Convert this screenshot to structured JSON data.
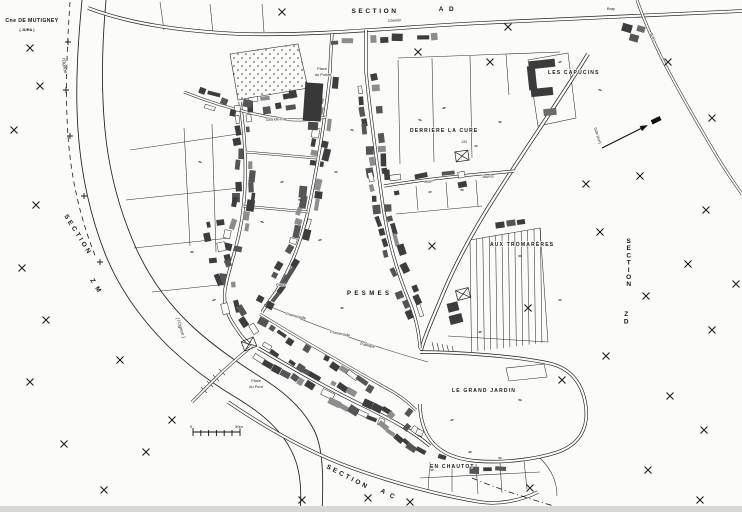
{
  "labels": {
    "commune_note": {
      "line1": "Cne DE MUTIGNEY",
      "line2": "( JURA )"
    },
    "sections": {
      "ad": {
        "word": "SECTION",
        "code": "AD"
      },
      "zm": {
        "word": "SECTION",
        "code": "ZM"
      },
      "zd": {
        "word": "SECTION",
        "code": "ZD"
      },
      "ac": {
        "word": "SECTION",
        "code": "AC"
      }
    },
    "lieux": {
      "capucins": "LES CAPUCINS",
      "cure": "DERRIERE LA CURE",
      "cure_parcel": "133",
      "tromareres": "AUX TROMARÈRES",
      "pesmes": "PESMES",
      "grand_jardin": "LE GRAND JARDIN",
      "chautot": "EN CHAUTOT"
    },
    "streets": {
      "chemin": "Chemin",
      "bray": "Bray",
      "gde_rue": "Gde (rue)",
      "jean": "Jean",
      "jaures": "Jaurès",
      "grande_rue": "Grande Rue",
      "place": "Place",
      "du_portail": "du Portail",
      "promenade": "Promenade",
      "publique": "Publique",
      "du_pont": "du Pont"
    },
    "river": {
      "small": "l'Ognon",
      "main": "( l'Ognon )"
    }
  },
  "scale_bar": {
    "left": "0",
    "right": "50m"
  },
  "icons": {
    "north_arrow": "north-arrow",
    "survey_cross": "cross-mark"
  },
  "colors": {
    "ink": "#1f1f1f",
    "paper": "#fbfbfa",
    "building_dark": "#3d3d3d",
    "building_mid": "#6a6a6a"
  }
}
